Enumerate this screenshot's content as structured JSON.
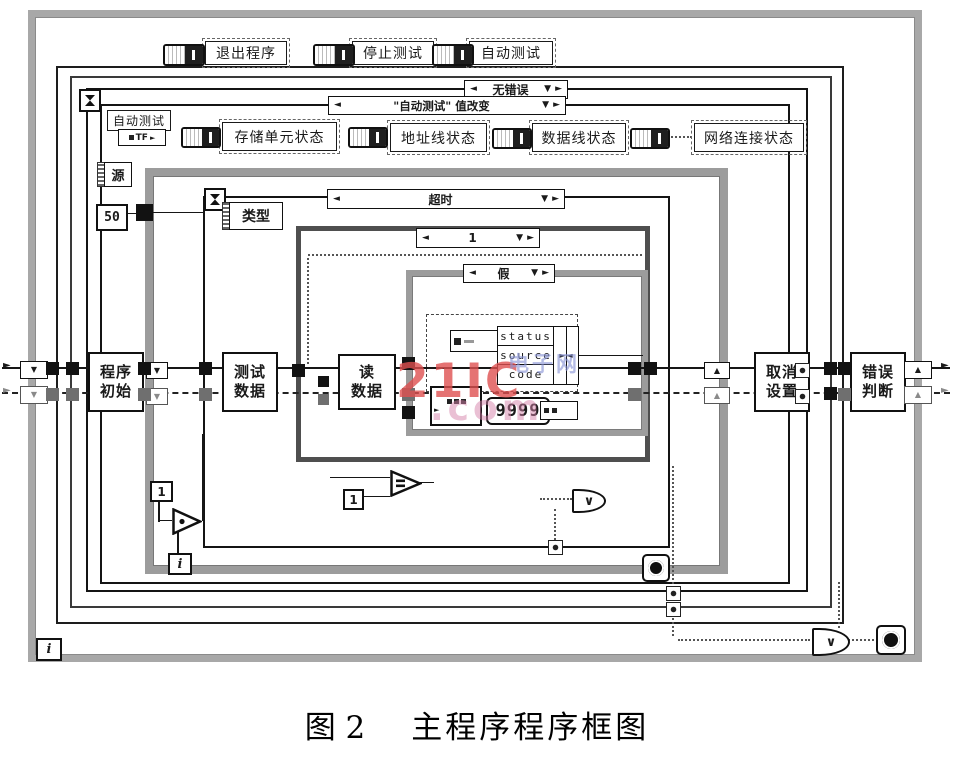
{
  "figure": {
    "caption": {
      "number": "图 2",
      "title": "主程序程序框图"
    },
    "watermark": {
      "brand": "21IC",
      "site": "电子网",
      "tld": ".com"
    }
  },
  "colors": {
    "paper": "#ffffff",
    "ink": "#1a1a1a",
    "gray_frame": "#9c9c9c",
    "dark_frame": "#4f4f4f",
    "watermark_red": "#de5050",
    "watermark_blue": "#8c96d7",
    "watermark_pink": "#d682aa"
  },
  "top_controls": {
    "buttons": [
      "退出程序",
      "停止测试",
      "自动测试"
    ]
  },
  "row2": {
    "auto_test_label": "自动测试",
    "bool_text": "TF",
    "status_labels": [
      "存储单元状态",
      "地址线状态",
      "数据线状态",
      "网络连接状态"
    ]
  },
  "selectors": {
    "outer_event": "无错误",
    "inner_event": "\"自动测试\"  值改变",
    "timeout_event": "超时",
    "case_number": "1",
    "case_false": "假"
  },
  "labels": {
    "source": "源",
    "type": "类型",
    "const_50": "50",
    "const_1a": "1",
    "const_1b": "1",
    "iter_i_inner": "i",
    "iter_i_outer": "i",
    "const_9999": "9999"
  },
  "nodes": {
    "program_init": "程序\n初始",
    "test_data": "测试\n数据",
    "read_data": "读\n数据",
    "cancel_setting": "取消\n设置",
    "error_judge": "错误\n判断"
  },
  "cluster": {
    "fields": [
      "status",
      "source",
      "code"
    ]
  },
  "glyphs": {
    "left": "◄",
    "right": "►",
    "down": "▼",
    "up": "▲",
    "or": "∨"
  }
}
